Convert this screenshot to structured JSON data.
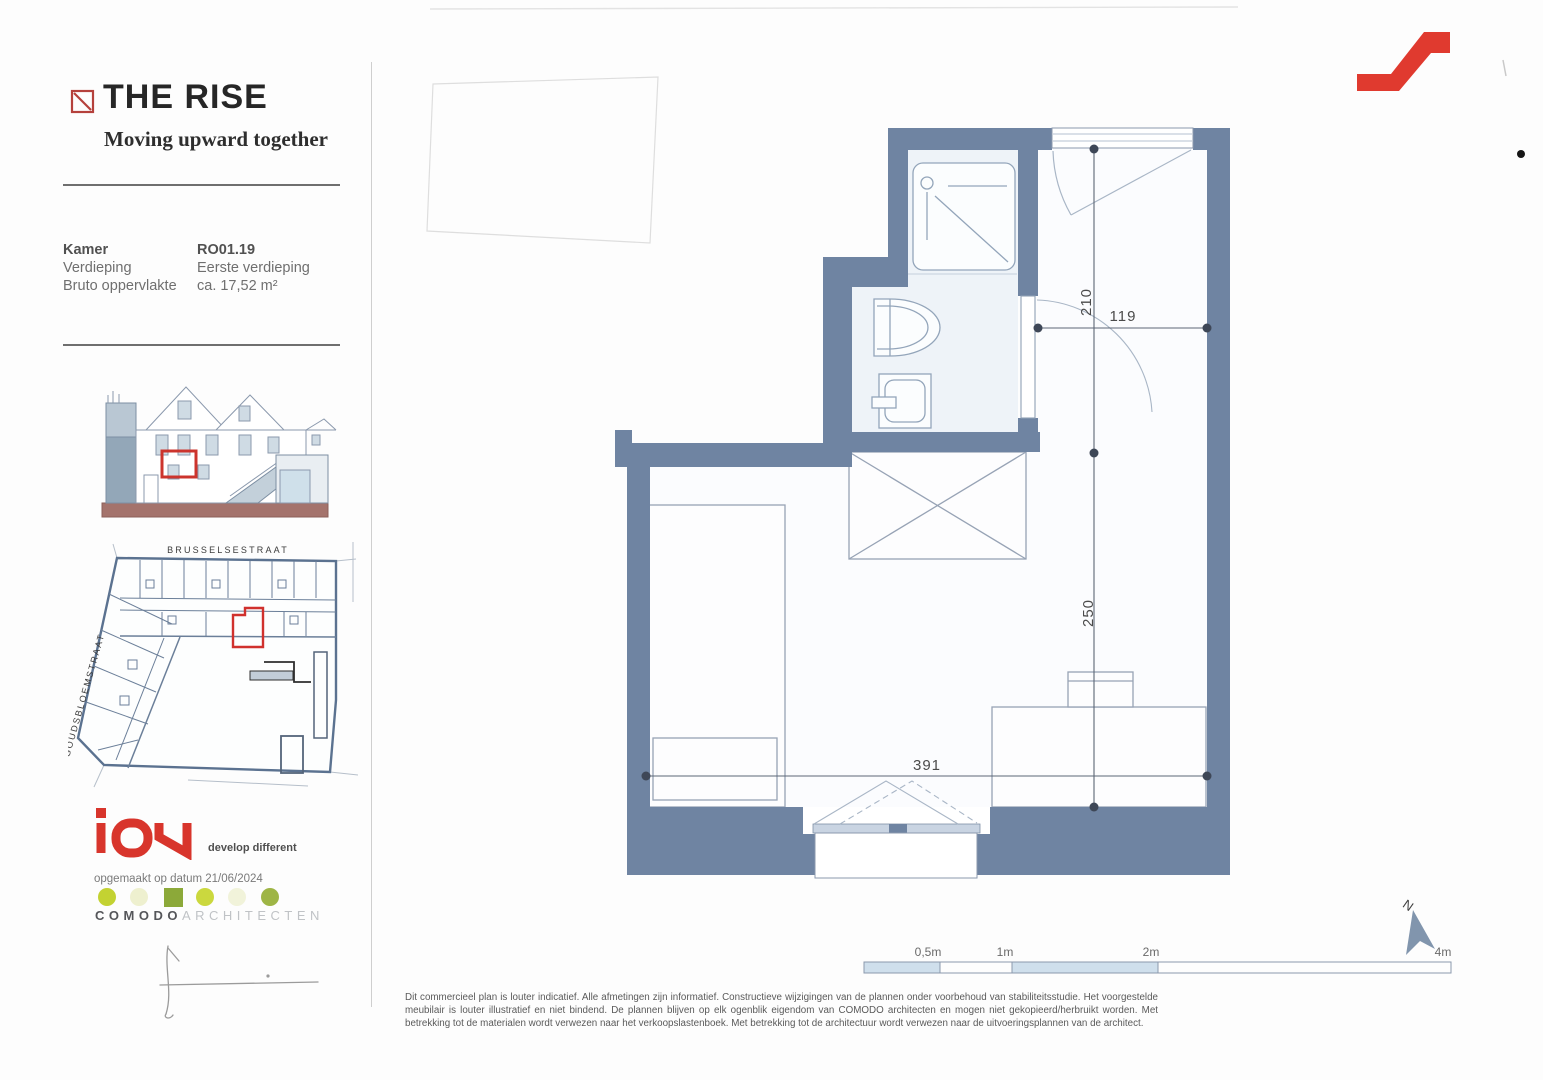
{
  "brand": {
    "title": "THE RISE",
    "tagline": "Moving upward together",
    "logo_mark": "red-square-diagonal"
  },
  "unit_info": {
    "rows": [
      {
        "label": "Kamer",
        "value": "RO01.19"
      },
      {
        "label": "Verdieping",
        "value": "Eerste verdieping"
      },
      {
        "label": "Bruto oppervlakte",
        "value": "ca. 17,52 m²"
      }
    ]
  },
  "site_plan": {
    "street_top": "BRUSSELSESTRAAT",
    "street_left": "GOUDSBLOEMSTRAAT"
  },
  "developer": {
    "name": "iON",
    "tagline": "develop different",
    "date_line": "opgemaakt op datum 21/06/2024"
  },
  "architect": {
    "name": "COMODO",
    "suffix": "ARCHITECTEN"
  },
  "floor_plan": {
    "dims": {
      "entry_depth": "210",
      "entry_width": "119",
      "room_depth": "250",
      "room_width": "391"
    }
  },
  "scale_bar": {
    "labels": [
      "0,5m",
      "1m",
      "2m",
      "4m"
    ]
  },
  "compass": {
    "label": "N"
  },
  "footer": {
    "disclaimer": "Dit commercieel plan is louter indicatief. Alle afmetingen zijn informatief. Constructieve wijzigingen van de plannen onder voorbehoud van stabiliteitsstudie. Het voorgestelde meubilair is louter illustratief en niet bindend. De plannen blijven op elk ogenblik eigendom van COMODO architecten en mogen niet gekopieerd/herbruikt worden. Met betrekking tot de materialen wordt verwezen naar het verkoopslastenboek. Met betrekking tot de architectuur wordt verwezen naar de uitvoeringsplannen van de architect."
  },
  "colors": {
    "wall": "#6f84a2",
    "accent_red": "#d0312d",
    "scale_fill": "#cfdfec"
  }
}
